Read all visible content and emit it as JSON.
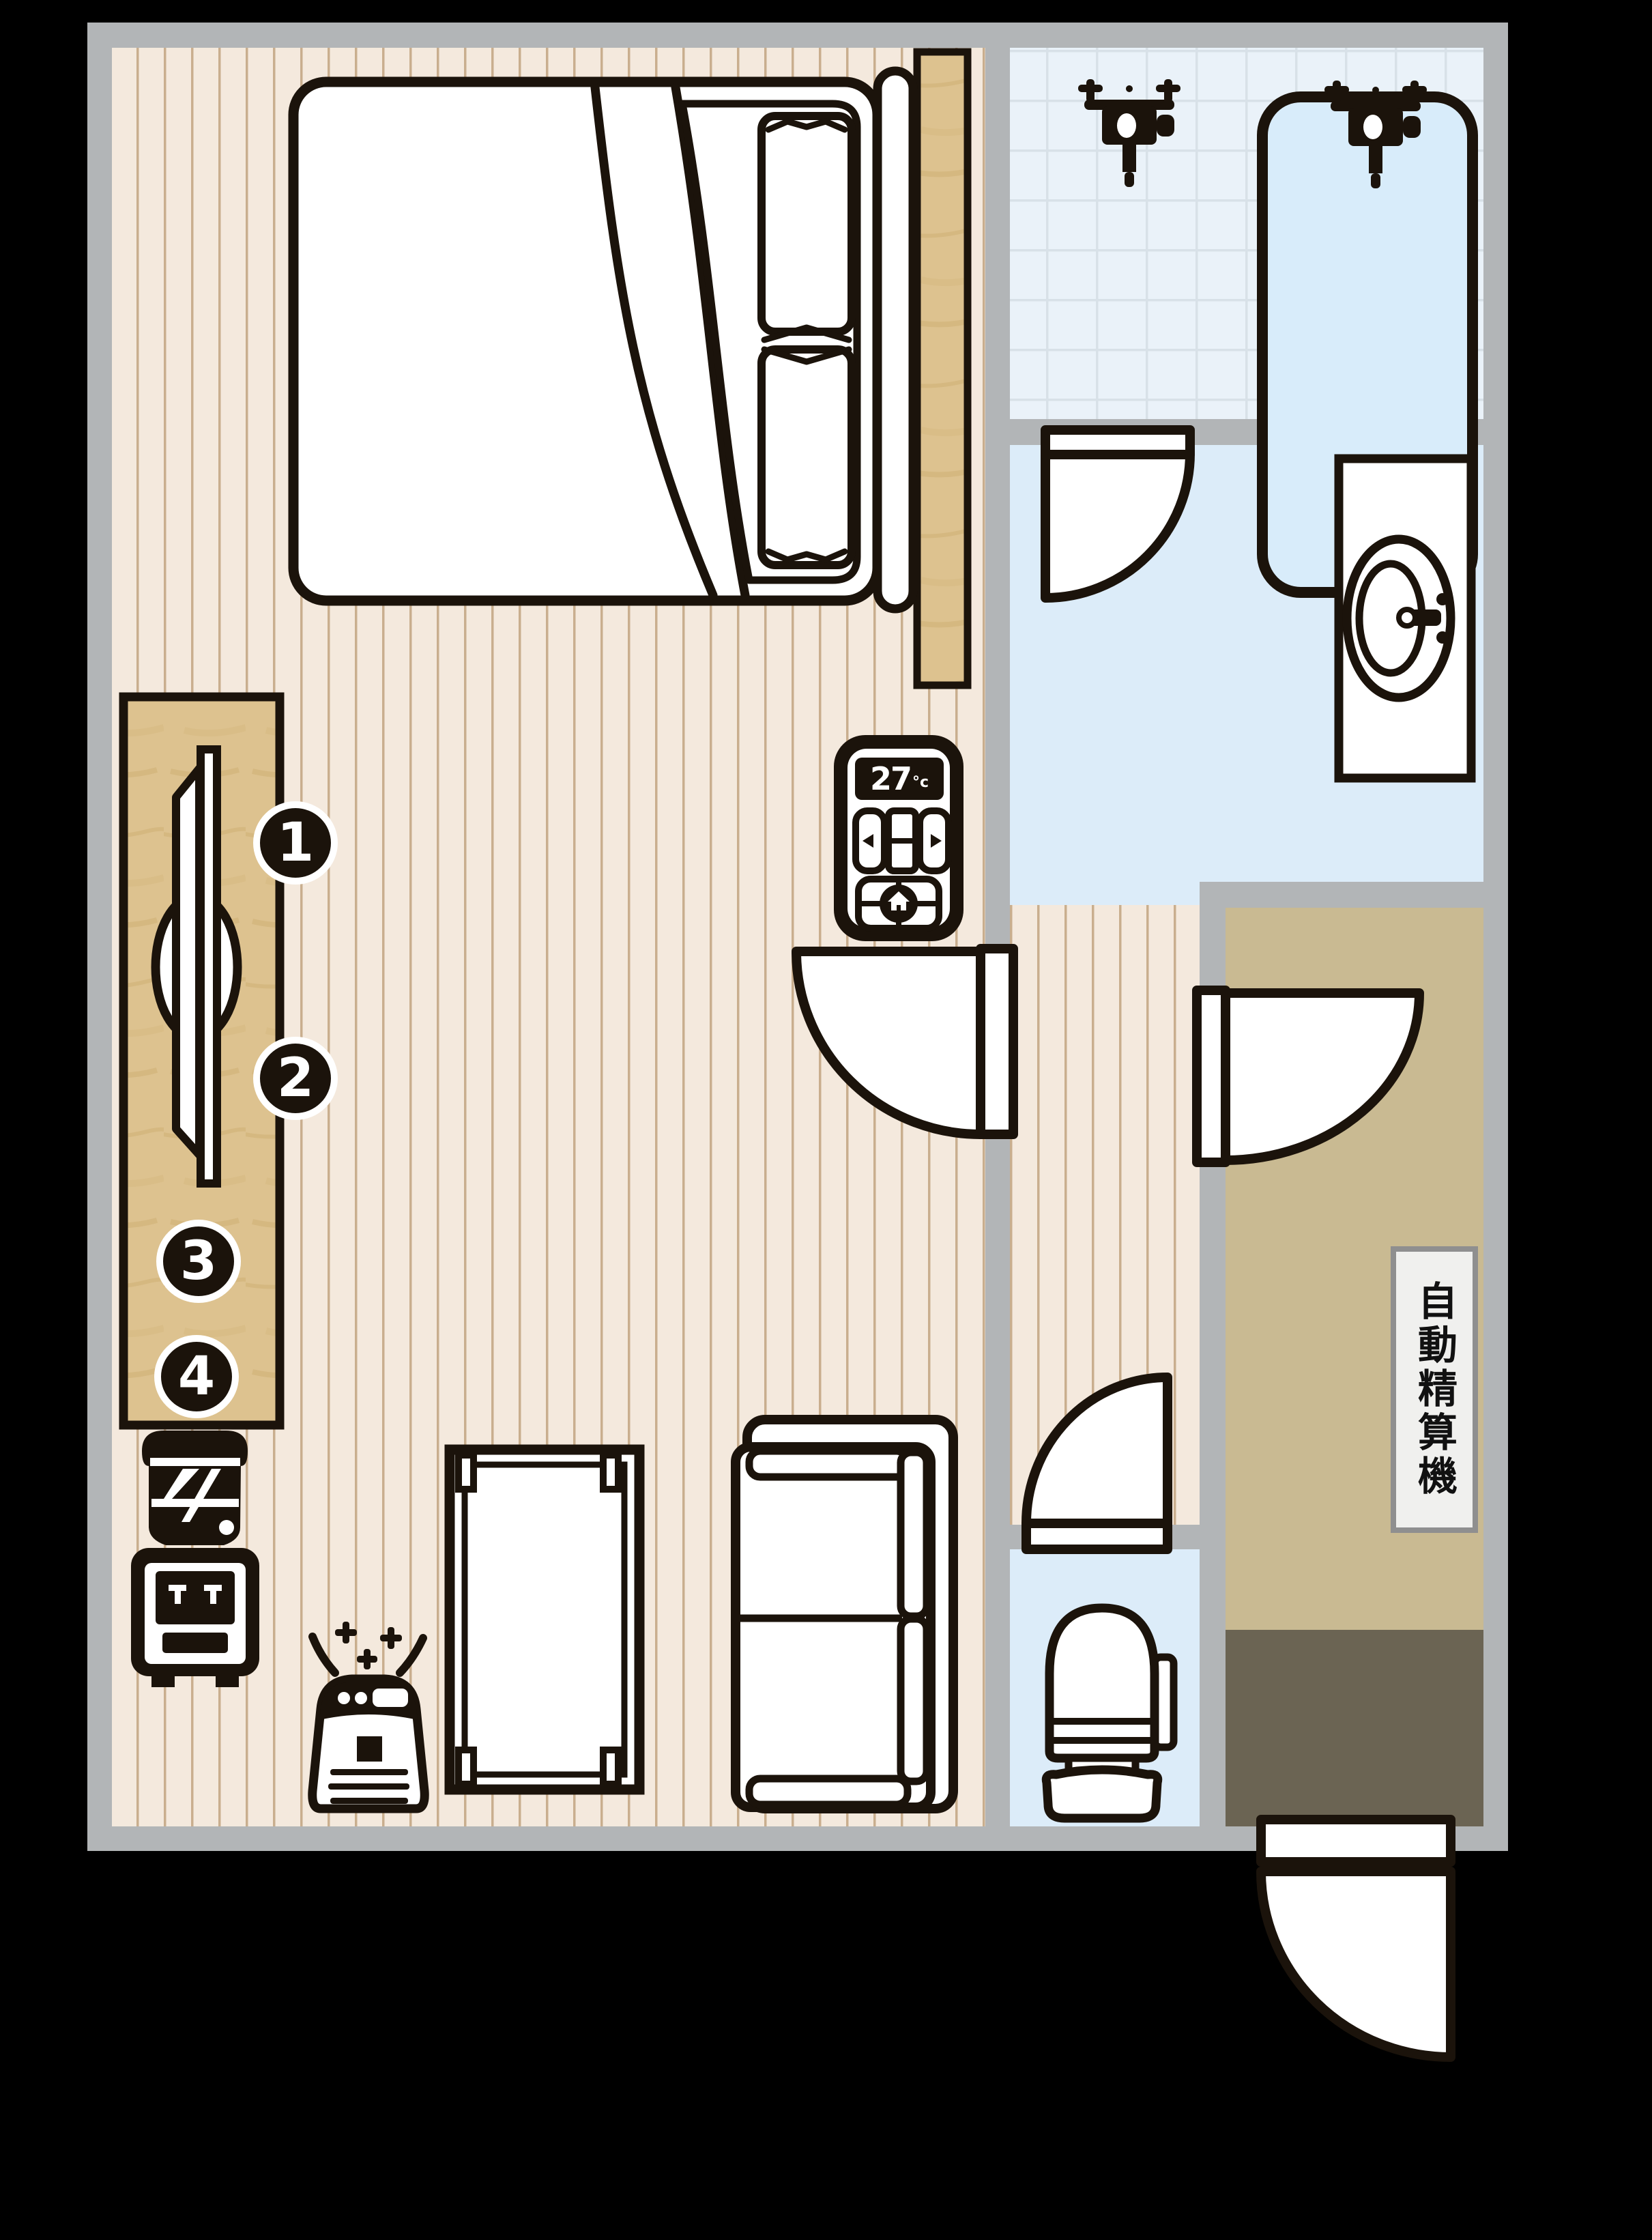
{
  "floorplan": {
    "sign": {
      "text": "自動精算機"
    },
    "ac_panel": {
      "temperature": "27",
      "unit": "°c"
    },
    "markers": [
      {
        "label": "1"
      },
      {
        "label": "2"
      },
      {
        "label": "3"
      },
      {
        "label": "4"
      }
    ],
    "colors": {
      "background": "#000000",
      "wall": "#b2b5b7",
      "bedroom_floor": "#f4e9dd",
      "floor_stripe": "#c9ae8e",
      "wood": "#ddc28f",
      "tile_floor": "#eaf2f9",
      "tile_grout": "#d8e1e8",
      "wet_room_floor": "#dcecf9",
      "bath_water": "#d8ecfa",
      "corridor_floor": "#c9ba92",
      "entry_floor": "#6b6453",
      "ink": "#1b130b",
      "sign_bg": "#f0f0ee",
      "sign_border": "#8f8f8f"
    },
    "icons": [
      "bed",
      "pillow",
      "headboard",
      "closet-panel",
      "desk",
      "tv-mirror",
      "water-dispenser-icon",
      "air-purifier-icon",
      "sparkle-icon",
      "table",
      "sofa",
      "ac-remote-icon",
      "home-icon",
      "left-arrow-icon",
      "right-arrow-icon",
      "bathtub",
      "shower-faucet-icon",
      "vanity-sink",
      "toilet",
      "door-swing",
      "auto-checkout-sign"
    ]
  }
}
